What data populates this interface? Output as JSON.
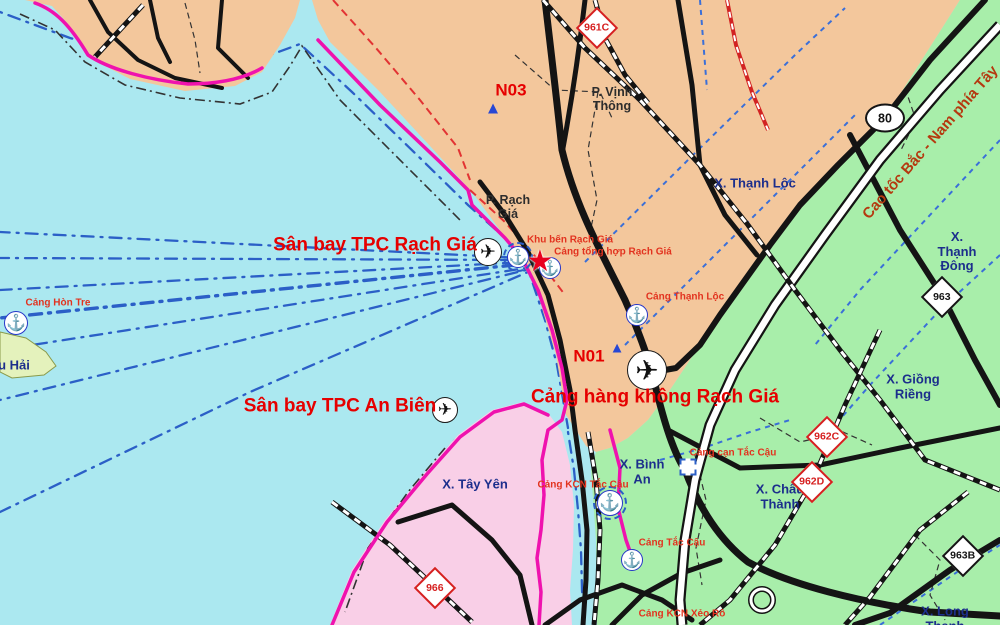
{
  "map": {
    "colors": {
      "sea": "#abe8f0",
      "land": "#f3c79c",
      "green": "#a8eeaa",
      "pink": "#f9cfe7",
      "island": "#e4f2bc",
      "boundary": "#ef12ae",
      "lanes": "#2b5fc7",
      "red": "#e60000",
      "redport": "#e2331f",
      "navy": "#1c2e8c",
      "hwy": "#b5390f"
    },
    "labels": [
      {
        "id": "san-bay-tpc-rach-gia",
        "text": "Sân bay TPC Rạch Giá",
        "x": 375,
        "y": 245,
        "cls": "red-big"
      },
      {
        "id": "san-bay-tpc-an-bien",
        "text": "Sân bay TPC An Biên",
        "x": 340,
        "y": 406,
        "cls": "red-big"
      },
      {
        "id": "cang-hang-khong-rach-gia",
        "text": "Cảng hàng không Rạch Giá",
        "x": 655,
        "y": 397,
        "cls": "red-big"
      },
      {
        "id": "zone-n03",
        "text": "N03",
        "x": 511,
        "y": 90,
        "cls": "red-code"
      },
      {
        "id": "zone-n01",
        "text": "N01",
        "x": 589,
        "y": 356,
        "cls": "red-code"
      },
      {
        "id": "p-vinh-thong",
        "text": "P. Vịnh\nThông",
        "x": 612,
        "y": 99,
        "cls": "ward"
      },
      {
        "id": "p-rach-gia",
        "text": "P. Rạch\nGiá",
        "x": 508,
        "y": 207,
        "cls": "ward"
      },
      {
        "id": "x-thanh-loc",
        "text": "X. Thạnh Lộc",
        "x": 755,
        "y": 184,
        "cls": "commune"
      },
      {
        "id": "x-thanh-dong",
        "text": "X. Thạnh\nĐông",
        "x": 957,
        "y": 252,
        "cls": "commune"
      },
      {
        "id": "x-giong-rieng",
        "text": "X. Giồng\nRiềng",
        "x": 913,
        "y": 387,
        "cls": "commune"
      },
      {
        "id": "x-chau-thanh",
        "text": "X. Châu\nThành",
        "x": 780,
        "y": 497,
        "cls": "commune"
      },
      {
        "id": "x-binh-an",
        "text": "X. Bình\nAn",
        "x": 642,
        "y": 472,
        "cls": "commune"
      },
      {
        "id": "x-tay-yen",
        "text": "X. Tây Yên",
        "x": 475,
        "y": 485,
        "cls": "commune"
      },
      {
        "id": "x-long-thanh",
        "text": "X. Long\nThạnh",
        "x": 945,
        "y": 619,
        "cls": "commune"
      },
      {
        "id": "island-hai",
        "text": "u Hải",
        "x": 14,
        "y": 366,
        "cls": "commune"
      },
      {
        "id": "cang-hon-tre",
        "text": "Cảng Hòn Tre",
        "x": 58,
        "y": 303,
        "cls": "red-small"
      },
      {
        "id": "khu-ben-rach-gia",
        "text": "Khu bến Rạch Giá",
        "x": 570,
        "y": 240,
        "cls": "red-small"
      },
      {
        "id": "cang-tong-hop-rach-gia",
        "text": "Cảng tổng hợp Rạch Giá",
        "x": 613,
        "y": 252,
        "cls": "red-small"
      },
      {
        "id": "cang-thanh-loc",
        "text": "Cảng Thạnh Lộc",
        "x": 685,
        "y": 297,
        "cls": "red-small"
      },
      {
        "id": "cang-kcn-tac-cau",
        "text": "Cảng KCN Tắc Cậu",
        "x": 583,
        "y": 485,
        "cls": "red-small"
      },
      {
        "id": "cang-can-tac-cau",
        "text": "Cảng cạn Tắc Cậu",
        "x": 733,
        "y": 453,
        "cls": "red-small"
      },
      {
        "id": "cang-tac-cau",
        "text": "Cảng Tắc Cậu",
        "x": 672,
        "y": 543,
        "cls": "red-small"
      },
      {
        "id": "cang-kcn-xeo-ro",
        "text": "Cảng KCN Xẻo Rô",
        "x": 682,
        "y": 614,
        "cls": "red-small"
      },
      {
        "id": "cao-toc-bac-nam",
        "text": "Cao tốc Bắc - Nam phía Tây",
        "x": 931,
        "y": 143,
        "cls": "hwy",
        "rot": -49
      }
    ],
    "shields": [
      {
        "id": "961c",
        "text": "961C",
        "x": 597,
        "y": 28,
        "style": "red"
      },
      {
        "id": "962c",
        "text": "962C",
        "x": 827,
        "y": 437,
        "style": "red"
      },
      {
        "id": "962d",
        "text": "962D",
        "x": 812,
        "y": 482,
        "style": "red"
      },
      {
        "id": "966",
        "text": "966",
        "x": 435,
        "y": 588,
        "style": "red"
      },
      {
        "id": "963",
        "text": "963",
        "x": 942,
        "y": 297,
        "style": "black"
      },
      {
        "id": "963b",
        "text": "963B",
        "x": 963,
        "y": 556,
        "style": "black"
      },
      {
        "id": "qa-80",
        "text": "80",
        "x": 885,
        "y": 118,
        "style": "ellipse"
      }
    ],
    "icons": [
      {
        "id": "plane-rach-gia",
        "kind": "plane",
        "x": 488,
        "y": 252,
        "r": 13
      },
      {
        "id": "plane-an-bien",
        "kind": "plane",
        "x": 445,
        "y": 410,
        "r": 12
      },
      {
        "id": "plane-cang-hang-khong",
        "kind": "plane",
        "x": 647,
        "y": 370,
        "r": 19
      },
      {
        "id": "anchor-hon-tre",
        "kind": "anchor",
        "x": 16,
        "y": 323,
        "r": 11
      },
      {
        "id": "anchor-port-1",
        "kind": "anchor",
        "x": 518,
        "y": 257,
        "r": 10,
        "dashed": true
      },
      {
        "id": "anchor-port-2",
        "kind": "anchor",
        "x": 550,
        "y": 268,
        "r": 10
      },
      {
        "id": "anchor-thanh-loc",
        "kind": "anchor",
        "x": 637,
        "y": 315,
        "r": 10
      },
      {
        "id": "anchor-kcn-tac-cau",
        "kind": "anchor",
        "x": 610,
        "y": 503,
        "r": 12,
        "dashed": true
      },
      {
        "id": "anchor-tac-cau",
        "kind": "anchor",
        "x": 632,
        "y": 560,
        "r": 10
      },
      {
        "id": "seaport-star",
        "kind": "star",
        "x": 540,
        "y": 262
      },
      {
        "id": "triangle-n03",
        "kind": "triangle",
        "x": 493,
        "y": 108,
        "s": 17
      },
      {
        "id": "triangle-n01",
        "kind": "triangle",
        "x": 617,
        "y": 348,
        "s": 15
      },
      {
        "id": "depot-tac-cau",
        "kind": "depot",
        "x": 688,
        "y": 467
      }
    ]
  }
}
